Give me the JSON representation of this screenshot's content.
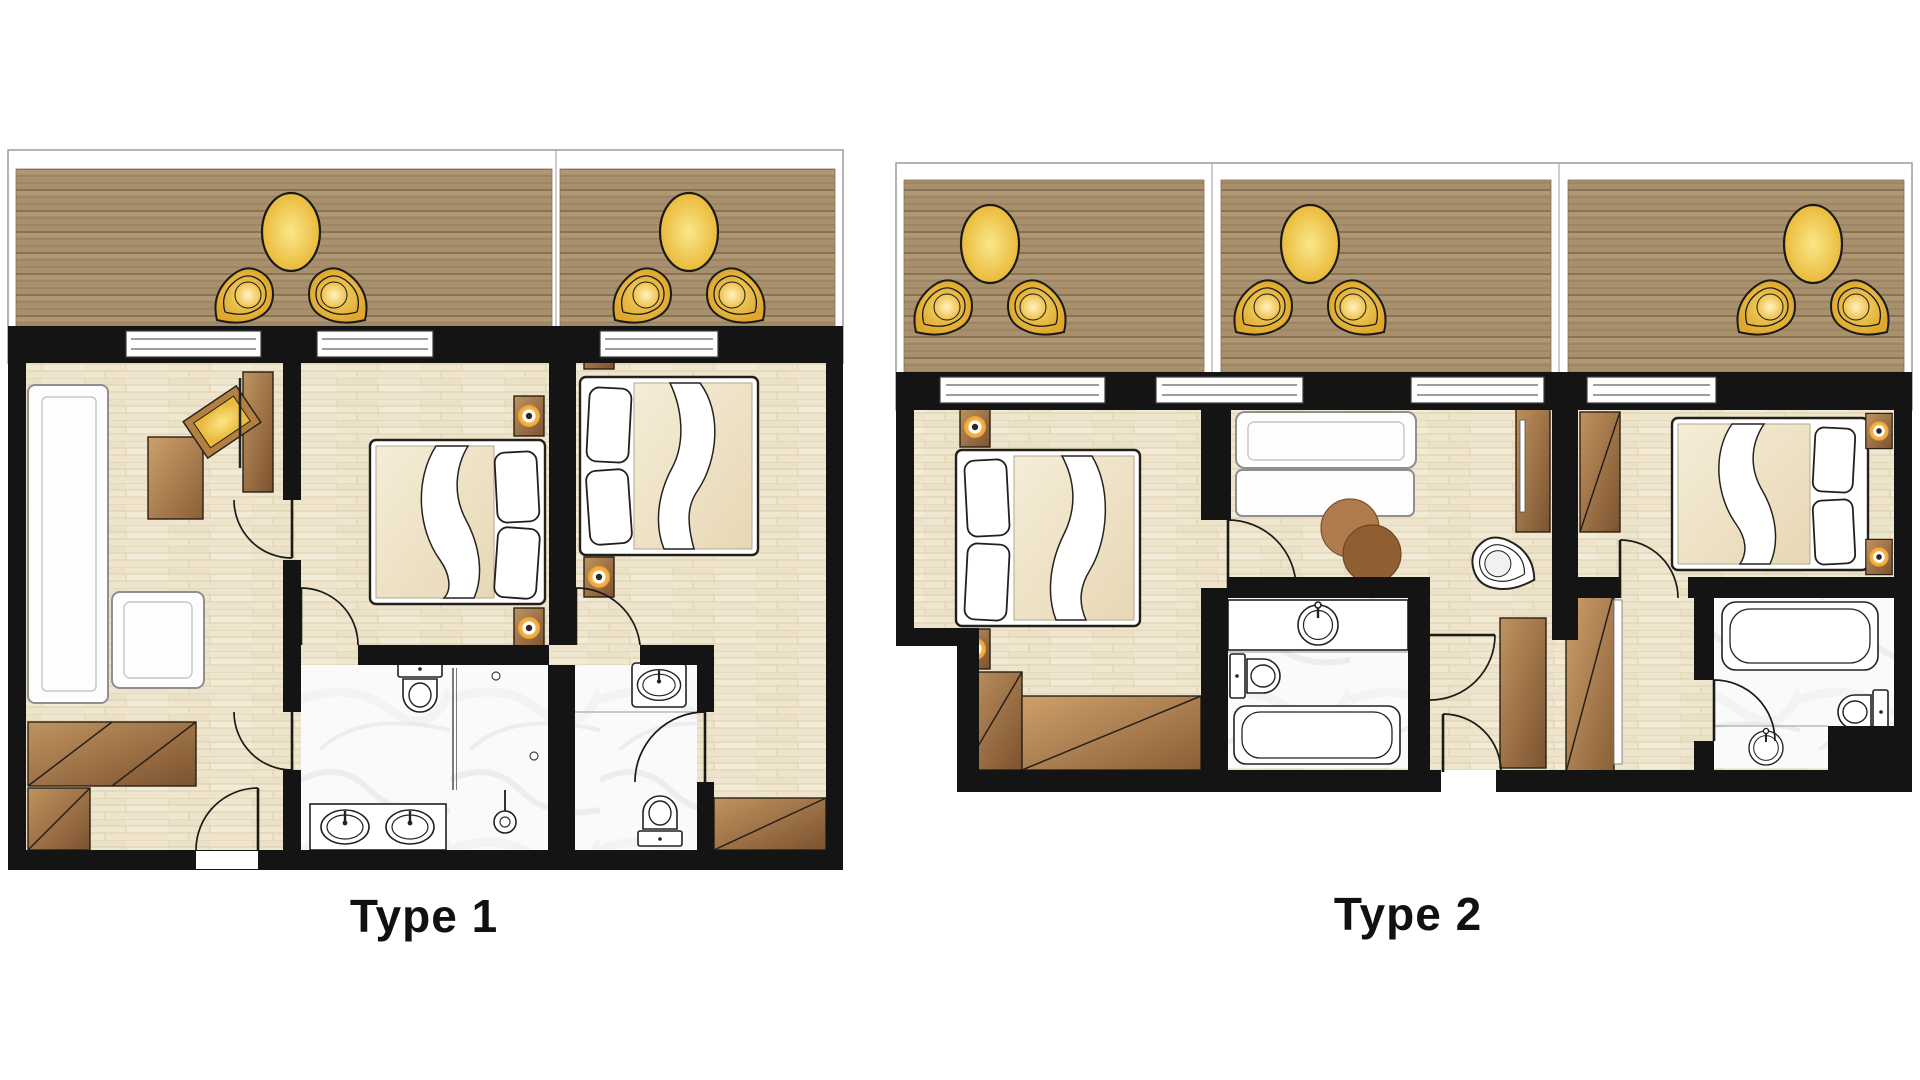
{
  "plans": [
    {
      "id": "type-1",
      "label": "Type 1",
      "features": [
        "balcony-terrace",
        "living-room",
        "bedroom",
        "second-bedroom",
        "bathroom",
        "shower-room",
        "wc",
        "entry-hall"
      ],
      "furniture_icons": [
        "patio-table-icon",
        "patio-chair-icon",
        "wall-lamp-icon",
        "sofa-icon",
        "armchair-icon",
        "coffee-table-icon",
        "tv-panel-icon",
        "double-bed-icon",
        "pillow-icon",
        "nightstand-lamp-icon",
        "wardrobe-icon",
        "toilet-icon",
        "double-sink-vanity-icon",
        "shower-head-icon",
        "sink-icon",
        "door-swing-icon",
        "window-icon"
      ]
    },
    {
      "id": "type-2",
      "label": "Type 2",
      "features": [
        "balcony-terrace",
        "bedroom-left",
        "living-room",
        "bedroom-right",
        "bathroom",
        "second-bathroom",
        "entry-hall"
      ],
      "furniture_icons": [
        "patio-table-icon",
        "patio-chair-icon",
        "double-bed-icon",
        "pillow-icon",
        "nightstand-lamp-icon",
        "sofa-icon",
        "round-coffee-table-icon",
        "lounge-chair-icon",
        "tv-panel-icon",
        "wardrobe-icon",
        "bathtub-icon",
        "toilet-icon",
        "round-sink-icon",
        "door-swing-icon",
        "window-icon"
      ]
    }
  ],
  "colors": {
    "wall": "#141414",
    "deck": "#a8906d",
    "deckStripe": "#8a7254",
    "floor": "#efe6cf",
    "floorLine": "#ddcfad",
    "marble": "#fafafb",
    "yellow": "#eaba3b",
    "yellowLight": "#fae789",
    "brown": "#a9784a",
    "brownDark": "#7c5230",
    "duvet": "#efe3c6",
    "ink": "#1a1a1a",
    "labelText": "#111111"
  }
}
